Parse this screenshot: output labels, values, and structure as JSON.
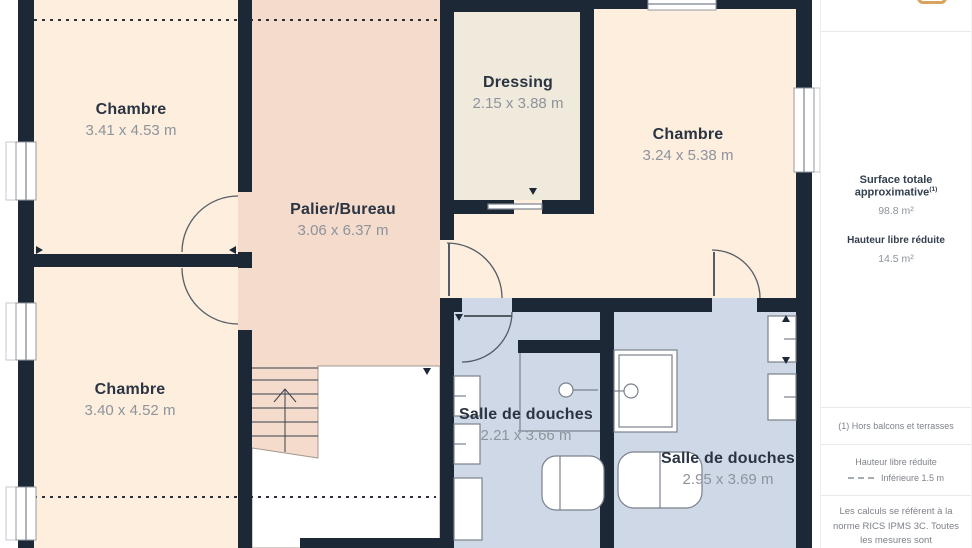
{
  "colors": {
    "wall": "#1d2837",
    "peach": "#fdeedd",
    "pink": "#f4dbcb",
    "beige": "#efeadb",
    "blue": "#cfd8e7",
    "accent": "#d8a35c",
    "text-dark": "#2a3443",
    "text-gray": "#8e939c",
    "divider": "#e9e9e9",
    "fixture": "#7a828e"
  },
  "rooms": [
    {
      "name": "Chambre",
      "dims": "3.41 x 4.53 m"
    },
    {
      "name": "Palier/Bureau",
      "dims": "3.06 x 6.37 m"
    },
    {
      "name": "Dressing",
      "dims": "2.15 x 3.88 m"
    },
    {
      "name": "Chambre",
      "dims": "3.24 x 5.38 m"
    },
    {
      "name": "Chambre",
      "dims": "3.40 x 4.52 m"
    },
    {
      "name": "Salle de douches",
      "dims": "2.21 x 3.66 m"
    },
    {
      "name": "Salle de douches",
      "dims": "2.95 x 3.69 m"
    }
  ],
  "sidebar": {
    "surface_title": "Surface totale approximative",
    "surface_superscript": "(1)",
    "surface_value": "98.8 m²",
    "height_title": "Hauteur libre réduite",
    "height_value": "14.5 m²",
    "footnote": "(1) Hors balcons et terrasses",
    "legend_title": "Hauteur libre réduite",
    "legend_item": "Inférieure 1.5 m",
    "disclaimer": "Les calculs se réfèrent à la norme RICS IPMS 3C. Toutes les mesures sont"
  }
}
